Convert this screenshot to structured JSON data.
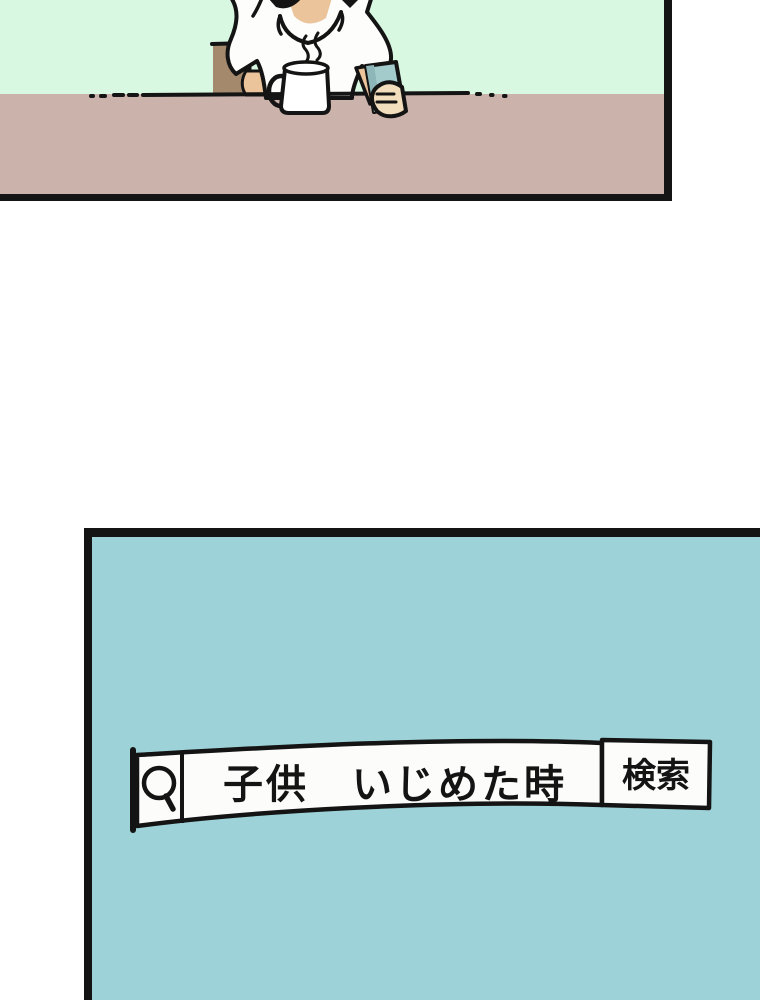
{
  "comic": {
    "panel_count": 2
  },
  "search_bar": {
    "query": "子供　いじめた時",
    "button_label": "検索",
    "icon": "magnifier"
  },
  "colors": {
    "page_bg": "#ffffff",
    "top_panel_bg": "#d8f8e1",
    "table": "#cbb2aa",
    "chair": "#a5896d",
    "skin": "#ecc49c",
    "hand_skin": "#f2ddbd",
    "shirt": "#fdfdfc",
    "phone": "#a3cbcb",
    "phone_shade": "#8db6b9",
    "mug": "#ffffff",
    "bottom_panel_bg": "#9dd3d8",
    "search_box": "#fcfcfb",
    "ink": "#141414"
  }
}
